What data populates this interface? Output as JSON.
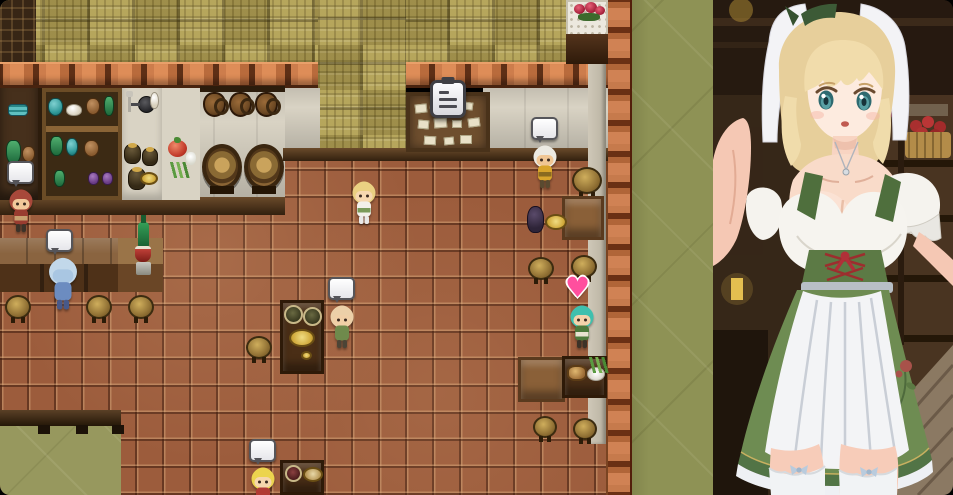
{
  "window": {
    "app": "rpg-game-window",
    "scene": "tavern-interior-with-waitress-portrait"
  },
  "game": {
    "icons": {
      "speech_bubble": "",
      "heart": "♥",
      "quest_board_icon": "clipboard-list"
    },
    "npcs": [
      {
        "id": "red-haired-patron",
        "indicator": "speech-bubble"
      },
      {
        "id": "blue-hooded-patron",
        "indicator": "speech-bubble"
      },
      {
        "id": "waitress-sprite",
        "indicator": null
      },
      {
        "id": "turbaned-merchant",
        "indicator": "speech-bubble"
      },
      {
        "id": "bald-patron",
        "indicator": "speech-bubble"
      },
      {
        "id": "teal-haired-girl",
        "indicator": "heart"
      },
      {
        "id": "blonde-child",
        "indicator": "speech-bubble"
      }
    ],
    "props": [
      "bulletin-board",
      "rose-vase-table",
      "wine-barrels",
      "hanging-jugs",
      "shelf-jars",
      "kitchen-utensils",
      "vegetables",
      "bar-counter",
      "stools",
      "dining-tables",
      "wine-bottle-and-cup"
    ]
  },
  "art_panel": {
    "subject": "blonde waitress in green dirndl with white veil and apron",
    "background_items": [
      "tavern-shelves",
      "apple-basket",
      "lantern",
      "wood-plank-floor"
    ]
  },
  "palette": {
    "floor_tile": "#9c5c3c",
    "wall_weave": "#b1a055",
    "green_void": "#8e9255",
    "brick": "#c67a4c",
    "counter_dark": "#4e3118",
    "white_wall": "#d9d3c4",
    "heart_pink": "#ff4f9e",
    "dirndl_green": "#5c7a45",
    "apron_white": "#f3f4f6",
    "hair_blonde": "#e7cf9b",
    "skin": "#f9dbc9"
  }
}
